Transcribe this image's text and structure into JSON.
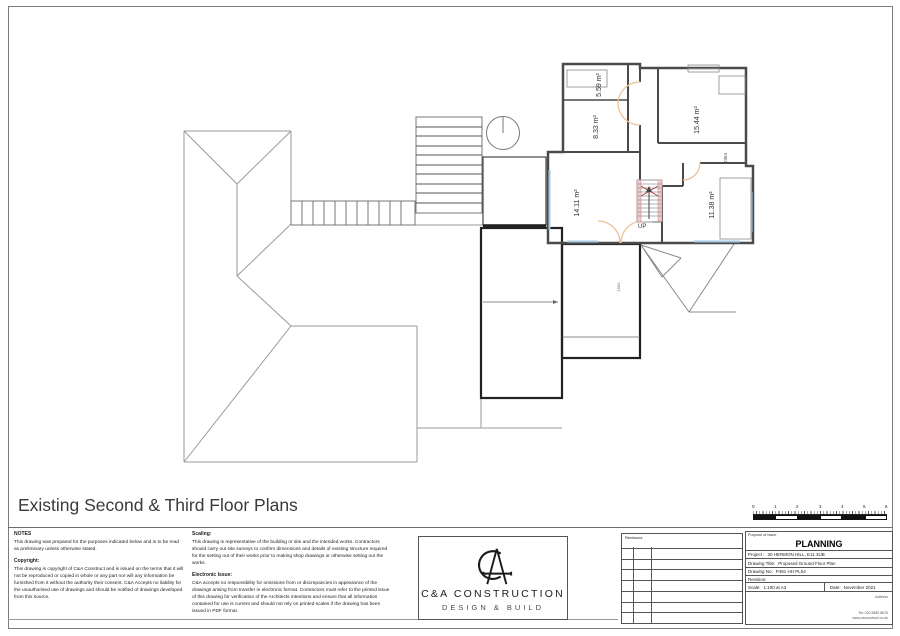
{
  "page": {
    "title": "Existing Second & Third Floor Plans"
  },
  "plan": {
    "rooms": [
      "5.59 m²",
      "8.33 m²",
      "15.44 m²",
      "14.11 m²",
      "11.38 m²"
    ],
    "up_label": "UP",
    "dim_2364": "2364",
    "dim_1902": "1902"
  },
  "notes": {
    "heading": "NOTES",
    "body": "This drawing was prepared for the purposes indicated below and is to be read as preliminary unless otherwise stated.",
    "copyright_heading": "Copyright:",
    "copyright_body": "This drawing is copyright of C&A Construct and is issued on the terms that it will not be reproduced or copied in whole or any part nor will any information be furnished from it without the authority their consent. C&A Accepts no liability for the unauthorised use of drawings and should be notified of drawings developed from this source."
  },
  "scaling": {
    "heading": "Scaling:",
    "body": "This drawing is representative of the building or site and the intended works. Contractors should carry out site surveys to confirm dimensions and details of existing structure required for the setting out of their works prior to making shop drawings or otherwise setting out the works.",
    "electronic_heading": "Electronic Issue:",
    "electronic_body": "C&A accepts no responsibility for omissions from or discrepancies in appearance of the drawings arising from transfer in electronic format. Contractors must refer to the printed issue of this drawing for verification of the Architects intentions and ensure that all information contained for use is current and should not rely on printed scales if the drawing has been issued in PDF format."
  },
  "logo": {
    "name": "C&A CONSTRUCTION",
    "tagline": "DESIGN & BUILD"
  },
  "revisions": {
    "heading": "Revisions"
  },
  "title_block": {
    "purpose_label": "Purpose of Issue",
    "purpose_value": "PLANNING",
    "project_label": "Project :",
    "project_value": "30 HERMON HILL, E11 3UB",
    "drawing_title_label": "Drawing Title:",
    "drawing_title_value": "Proposed Ground Floor Plan",
    "drawing_no_label": "Drawing No:",
    "drawing_no_value": "P481 HH PL04",
    "revision_label": "Revision:",
    "scale_label": "Scale:",
    "scale_value": "1:100 at A3",
    "date_label": "Date:",
    "date_value": "November 2021",
    "address_label": "Address",
    "tel": "Tel: 020 8480 8675",
    "website": "www.caconstruct.co.uk"
  },
  "scale_bar": {
    "numbers": [
      "0",
      "1",
      "2",
      "3",
      "4",
      "5",
      "6"
    ]
  },
  "colors": {
    "wall": "#4a4a4a",
    "roof_line": "#9a9a9a",
    "door": "#eec39a",
    "window": "#a6c9e2",
    "stair_accent": "#edc9c9",
    "title_text": "#3a3a3a"
  }
}
